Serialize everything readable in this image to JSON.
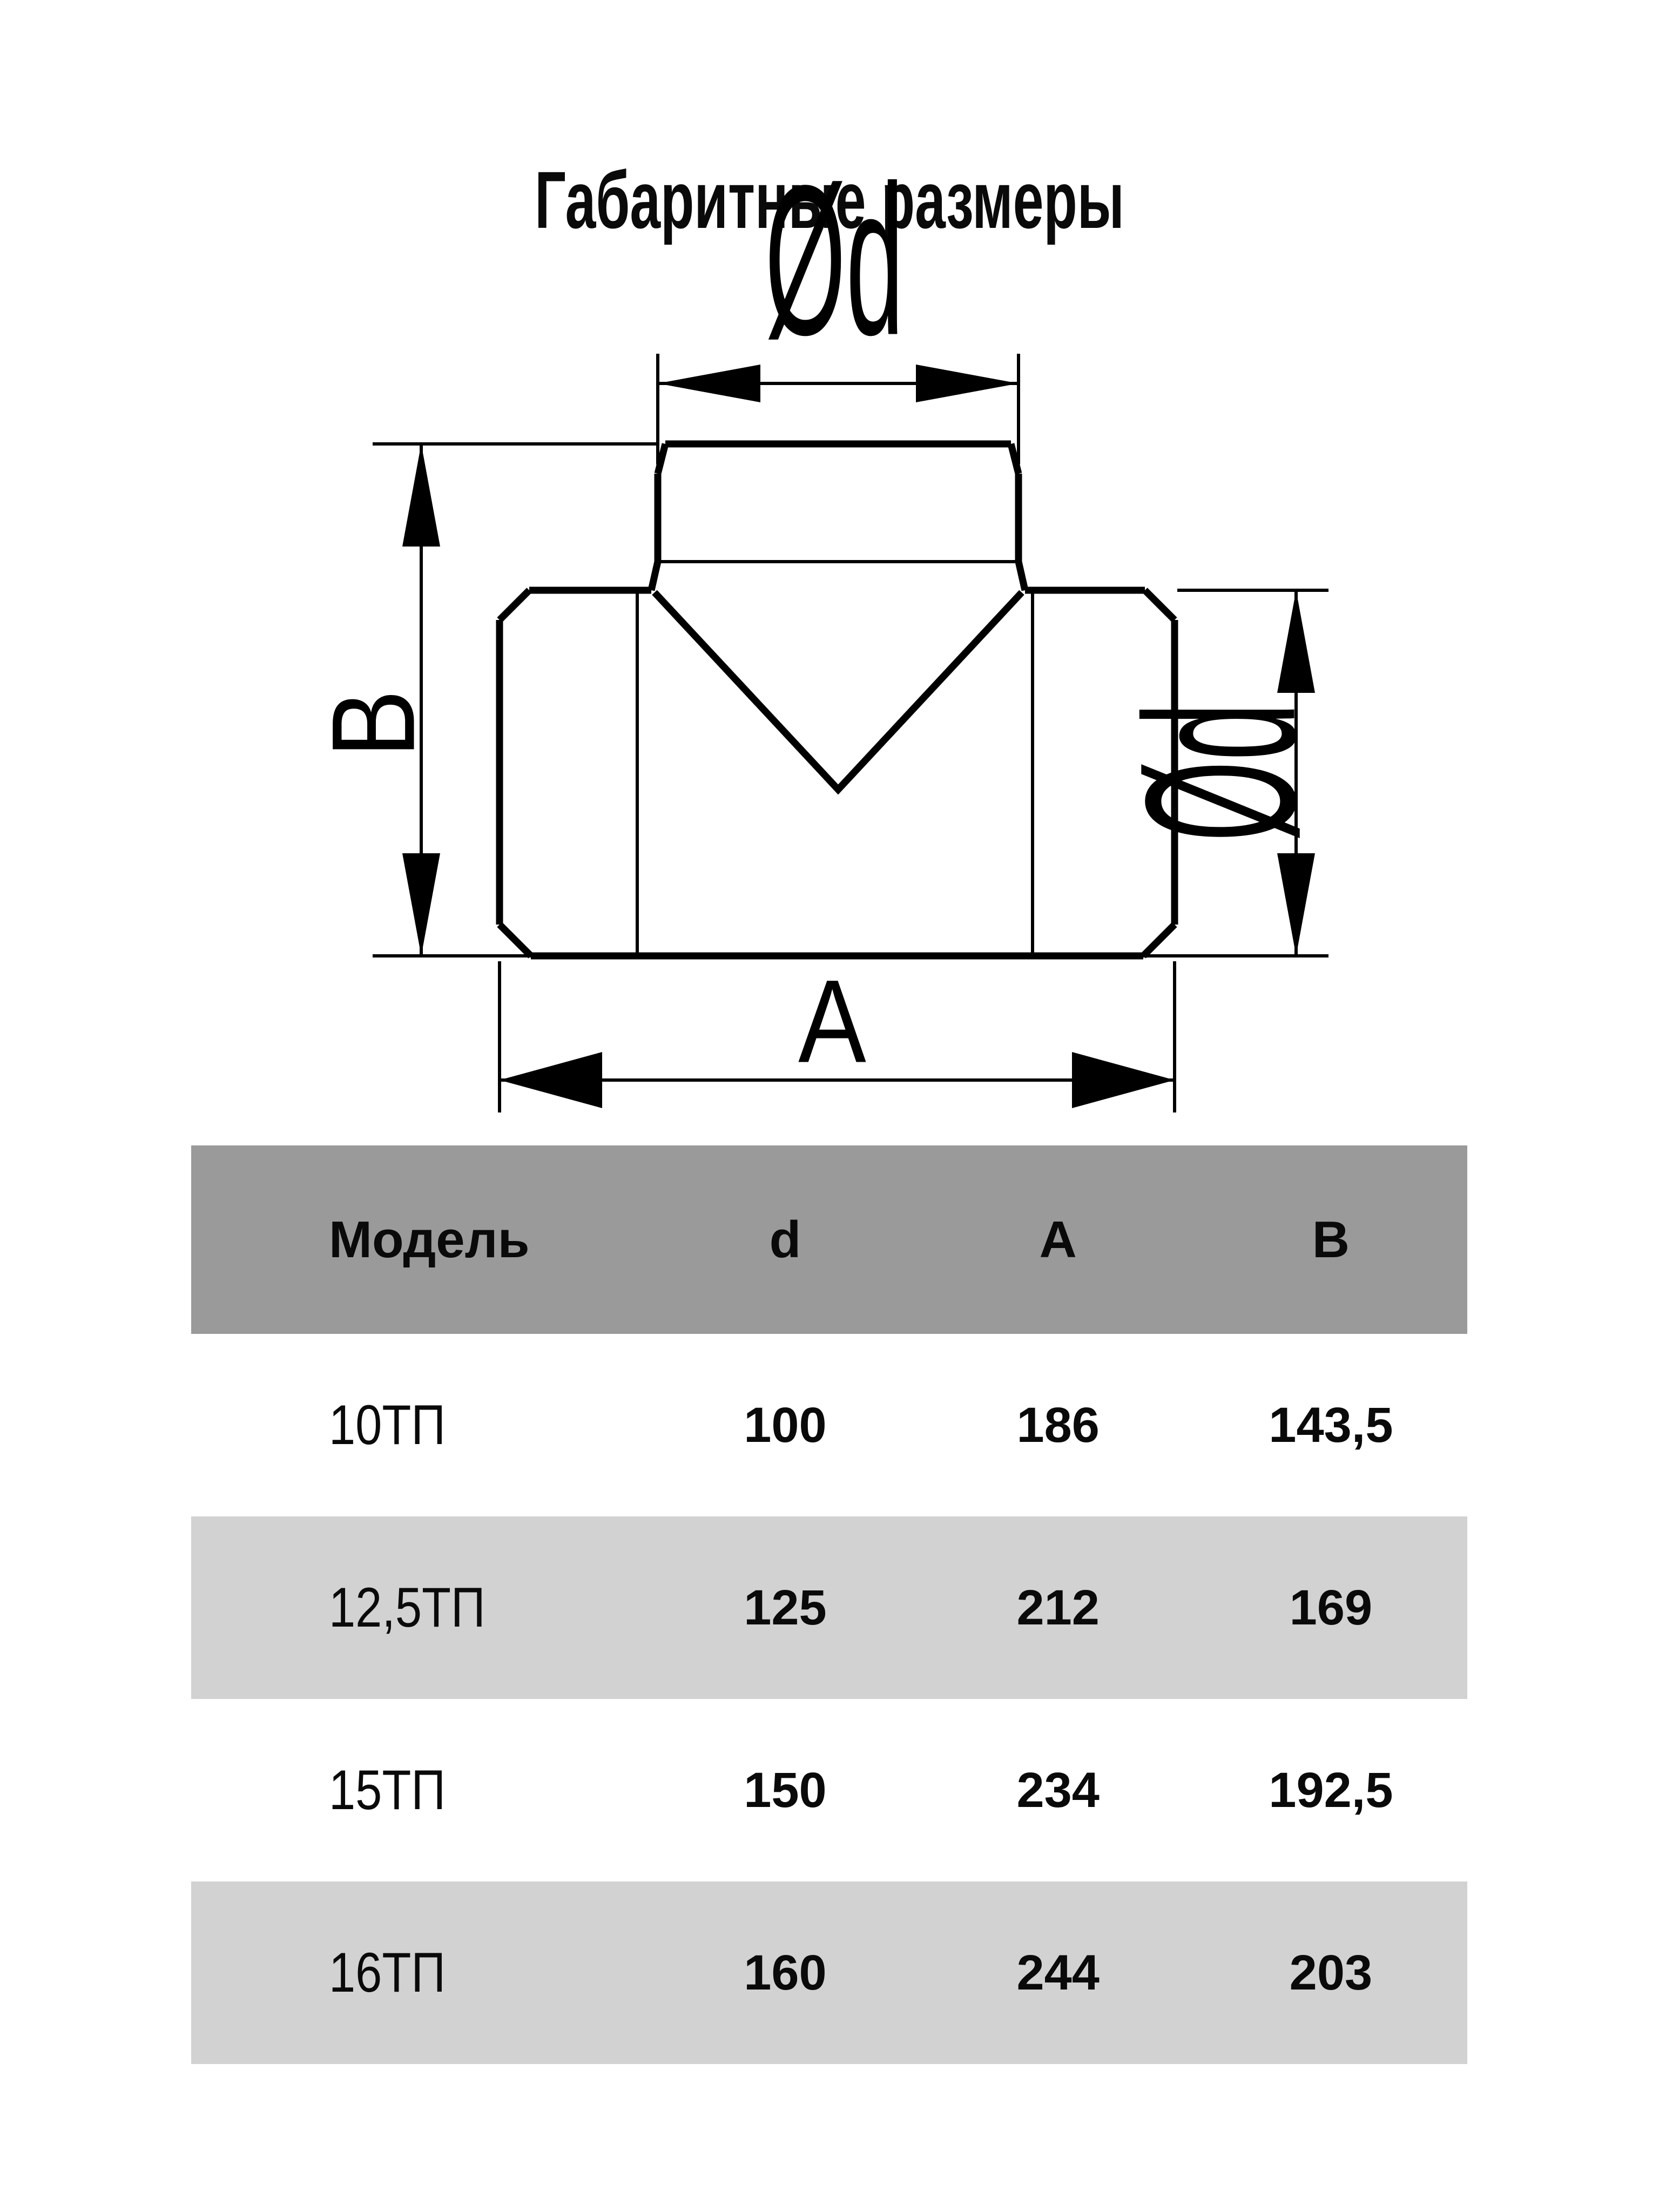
{
  "page": {
    "title": "Габаритные размеры",
    "background_color": "#ffffff"
  },
  "diagram": {
    "type": "technical-drawing-tee-duct-fitting",
    "line_color": "#000000",
    "labels": {
      "top_diameter": "Ød",
      "height_dim": "B",
      "length_dim": "A",
      "side_diameter": "Ød"
    }
  },
  "table": {
    "header_bg": "#9a9a9a",
    "alt_row_bg": "#d2d2d2",
    "text_color": "#0a0a0a",
    "columns": {
      "model": "Модель",
      "d": "d",
      "a": "A",
      "b": "B"
    },
    "rows": [
      {
        "model": "10ТП",
        "d": "100",
        "a": "186",
        "b": "143,5"
      },
      {
        "model": "12,5ТП",
        "d": "125",
        "a": "212",
        "b": "169"
      },
      {
        "model": "15ТП",
        "d": "150",
        "a": "234",
        "b": "192,5"
      },
      {
        "model": "16ТП",
        "d": "160",
        "a": "244",
        "b": "203"
      }
    ]
  }
}
